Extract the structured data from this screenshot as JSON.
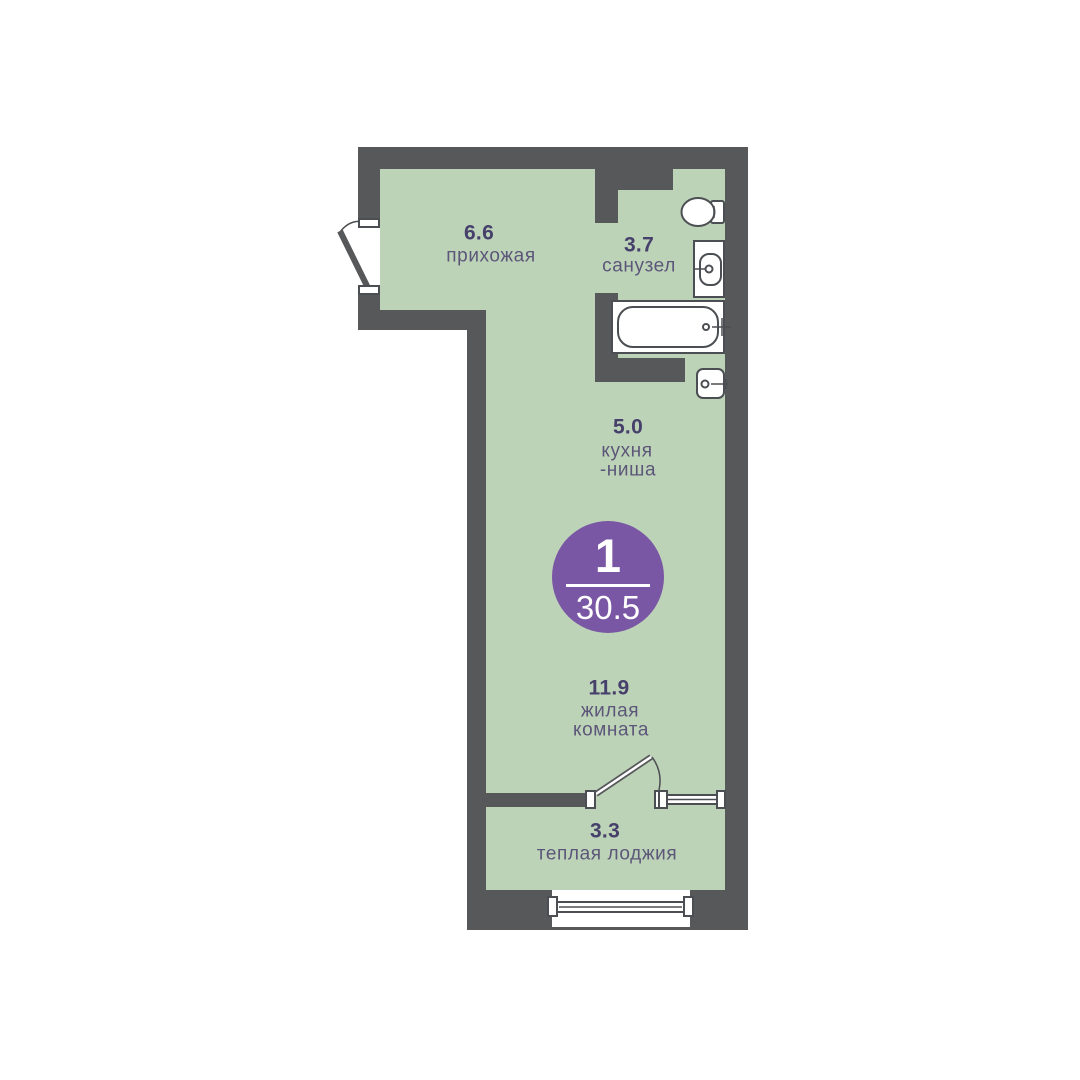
{
  "badge": {
    "rooms_count": "1",
    "total_area": "30.5"
  },
  "rooms": {
    "hallway": {
      "area": "6.6",
      "name": "прихожая"
    },
    "bathroom": {
      "area": "3.7",
      "name": "санузел"
    },
    "kitchen": {
      "area": "5.0",
      "name_line1": "кухня",
      "name_line2": "-ниша"
    },
    "living": {
      "area": "11.9",
      "name_line1": "жилая",
      "name_line2": "комната"
    },
    "loggia": {
      "area": "3.3",
      "name": "теплая лоджия"
    }
  },
  "icons": [
    "entrance-door-icon",
    "toilet-icon",
    "bathroom-sink-icon",
    "bathtub-icon",
    "kitchen-sink-icon",
    "interior-door-icon",
    "loggia-window-icon",
    "bottom-window-icon"
  ],
  "colors": {
    "wall": "#56585a",
    "room_fill": "#bdd3b8",
    "accent": "#7a57a4",
    "number_text": "#46406b",
    "label_text": "#5c5679",
    "fixture_stroke": "#4b4e52",
    "background": "#ffffff"
  }
}
